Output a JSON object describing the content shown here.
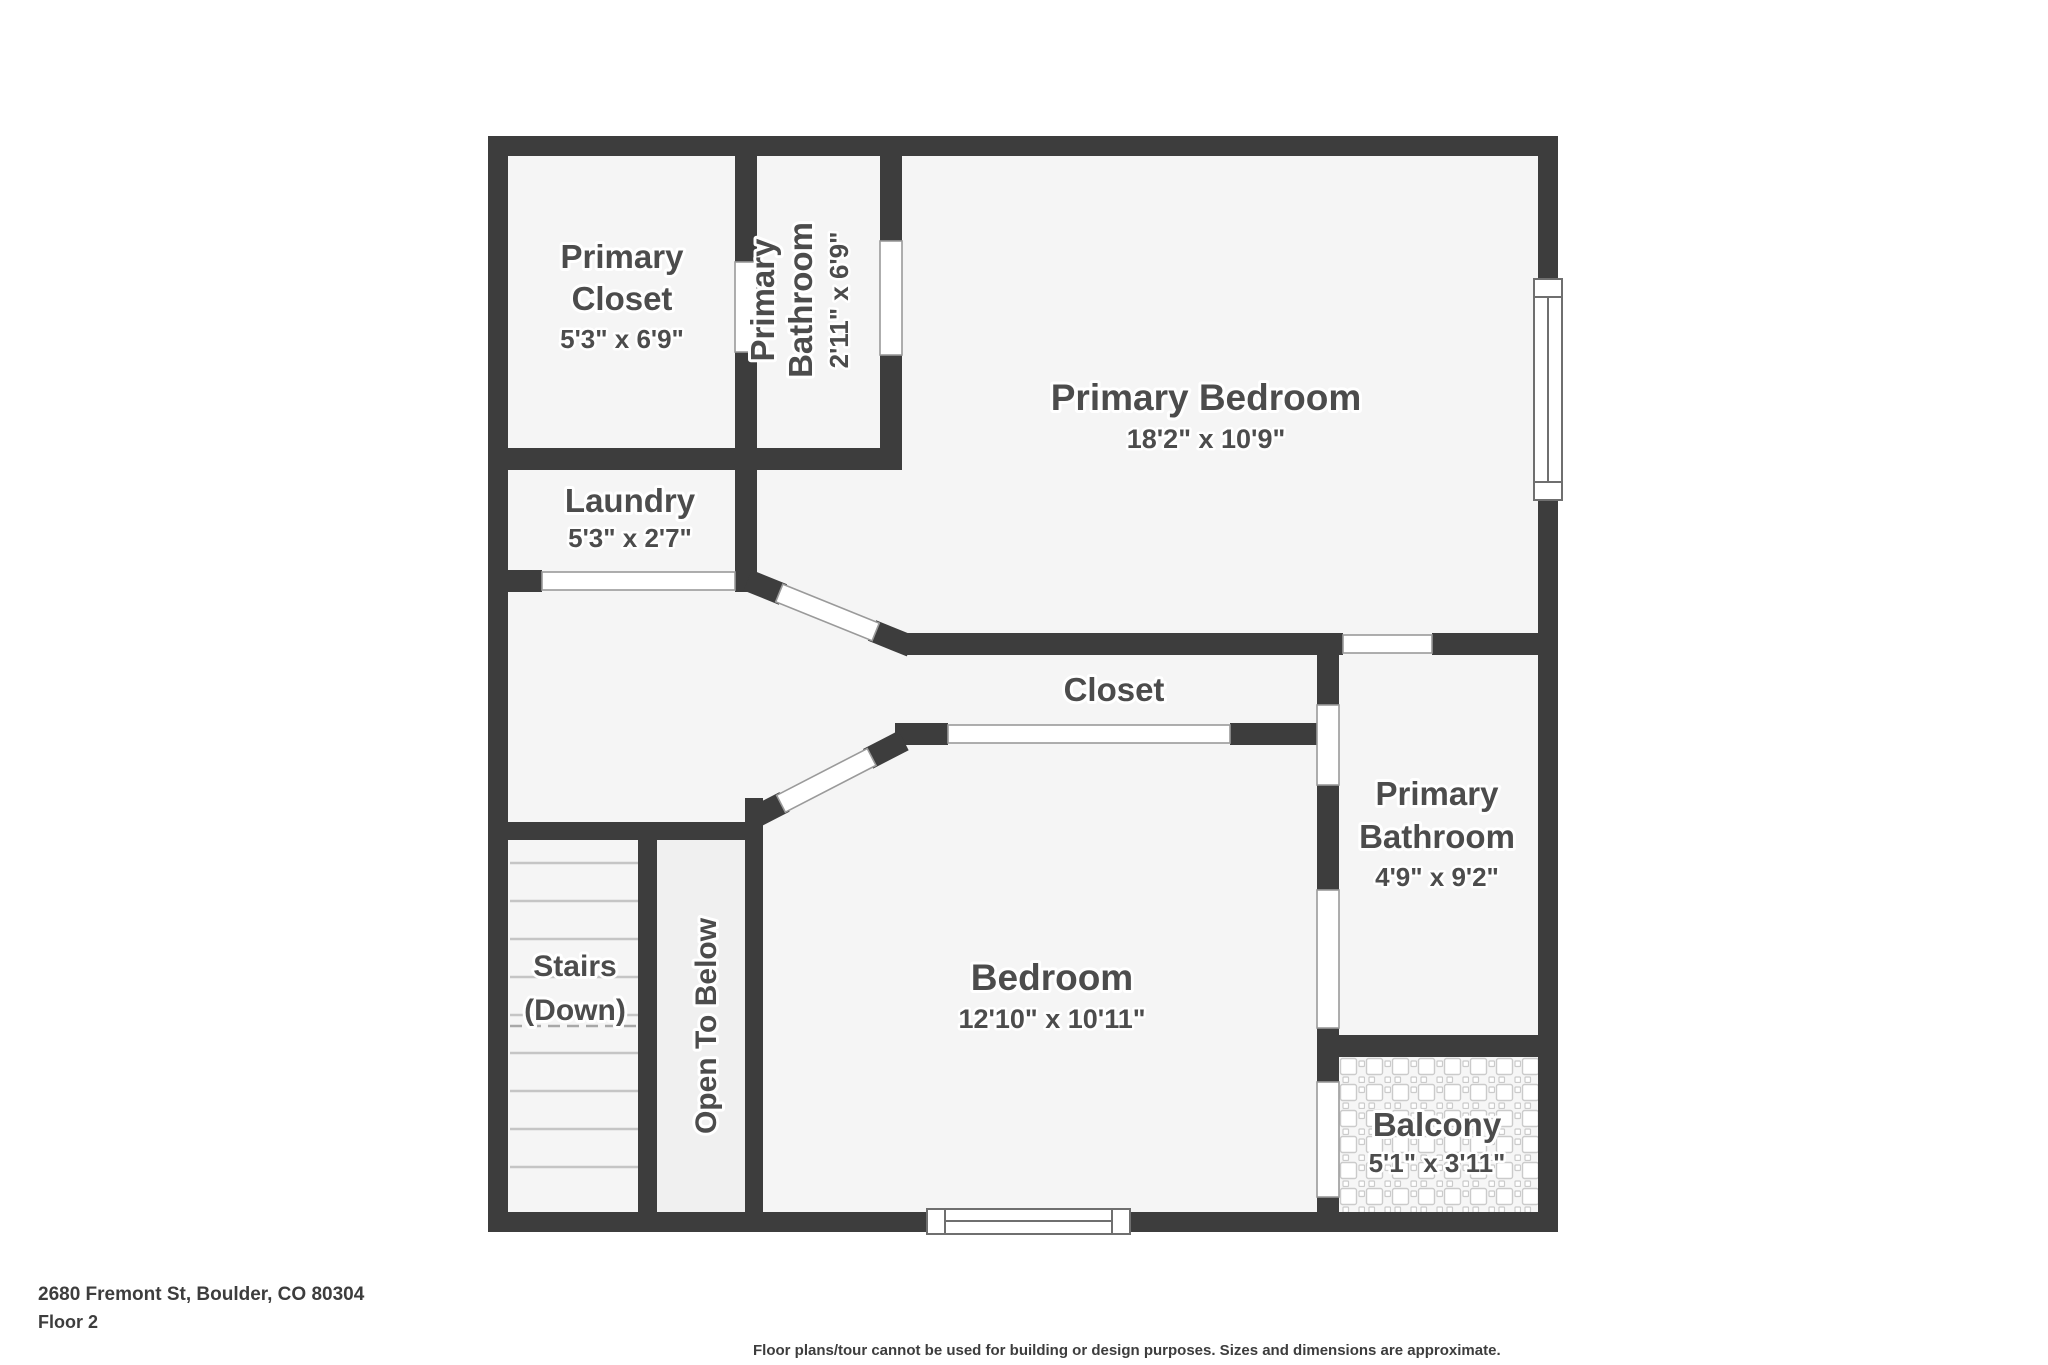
{
  "colors": {
    "wall": "#3d3d3d",
    "floor": "#f5f5f5",
    "floor_open_to_below": "#f0f0f0",
    "label": "#4c4c4c",
    "door_outline": "#9a9a9a",
    "window_outline": "#6f6f6f",
    "step_line": "#c5c5c5",
    "tile_line": "#cbcbcb",
    "footer_text": "#3d3d3d"
  },
  "rooms": {
    "primary_closet": {
      "name_line1": "Primary",
      "name_line2": "Closet",
      "dims": "5'3\" x 6'9\""
    },
    "primary_bathroom_top": {
      "name_line1": "Primary",
      "name_line2": "Bathroom",
      "dims": "2'11\" x 6'9\""
    },
    "primary_bedroom": {
      "name": "Primary Bedroom",
      "dims": "18'2\" x 10'9\""
    },
    "laundry": {
      "name": "Laundry",
      "dims": "5'3\" x 2'7\""
    },
    "closet": {
      "name": "Closet"
    },
    "primary_bathroom_right": {
      "name_line1": "Primary",
      "name_line2": "Bathroom",
      "dims": "4'9\" x 9'2\""
    },
    "bedroom": {
      "name": "Bedroom",
      "dims": "12'10\" x 10'11\""
    },
    "stairs": {
      "name_line1": "Stairs",
      "name_line2": "(Down)"
    },
    "open_to_below": {
      "name": "Open To Below"
    },
    "balcony": {
      "name": "Balcony",
      "dims": "5'1\" x 3'11\""
    }
  },
  "footer": {
    "address": "2680 Fremont St, Boulder, CO 80304",
    "floor_label": "Floor 2",
    "disclaimer": "Floor plans/tour cannot be used for building or design purposes. Sizes and dimensions are approximate."
  }
}
